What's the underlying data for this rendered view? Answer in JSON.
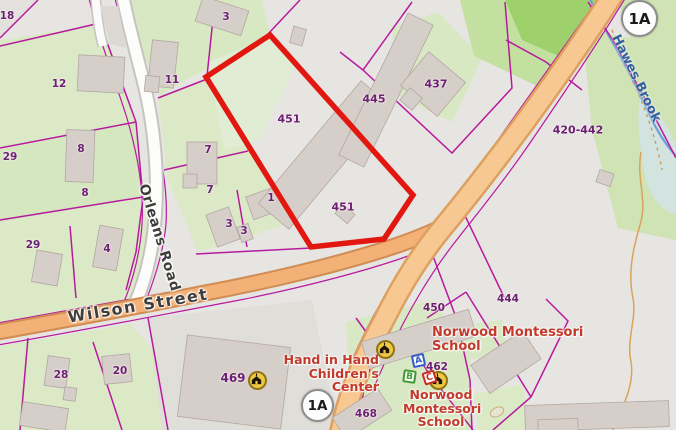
{
  "parcel_labels": [
    {
      "text": "18"
    },
    {
      "text": "3"
    },
    {
      "text": "12"
    },
    {
      "text": "11"
    },
    {
      "text": "29"
    },
    {
      "text": "8"
    },
    {
      "text": "8"
    },
    {
      "text": "7"
    },
    {
      "text": "7"
    },
    {
      "text": "29"
    },
    {
      "text": "4"
    },
    {
      "text": "1"
    },
    {
      "text": "3"
    },
    {
      "text": "3"
    },
    {
      "text": "451"
    },
    {
      "text": "451"
    },
    {
      "text": "445"
    },
    {
      "text": "437"
    },
    {
      "text": "420-442"
    },
    {
      "text": "450"
    },
    {
      "text": "444"
    },
    {
      "text": "462"
    },
    {
      "text": "28"
    },
    {
      "text": "20"
    },
    {
      "text": "469"
    },
    {
      "text": "468"
    }
  ],
  "streets": {
    "wilson": "Wilson Street",
    "orleans": "Orleans Road",
    "brook": "Hawes Brook"
  },
  "pois": {
    "hand_in_hand": {
      "line1": "Hand in Hand",
      "line2": "Children's",
      "line3": "Center"
    },
    "norwood_upper": {
      "line1": "Norwood Montessori",
      "line2": "School"
    },
    "norwood_lower": {
      "line1": "Norwood",
      "line2": "Montessori",
      "line3": "School"
    }
  },
  "shields": {
    "top": "1A",
    "bottom": "1A"
  },
  "blocks": {
    "a": "A",
    "b": "B",
    "c": "C"
  },
  "colors": {
    "highlight_outline": "#e21710",
    "parcel_line": "#b81a9e",
    "parcel_label": "#6d1f73",
    "poi_label": "#c23a2b",
    "road_primary_fill": "#f7c892",
    "road_secondary_fill": "#f3b177",
    "water": "#6f9fd8"
  }
}
